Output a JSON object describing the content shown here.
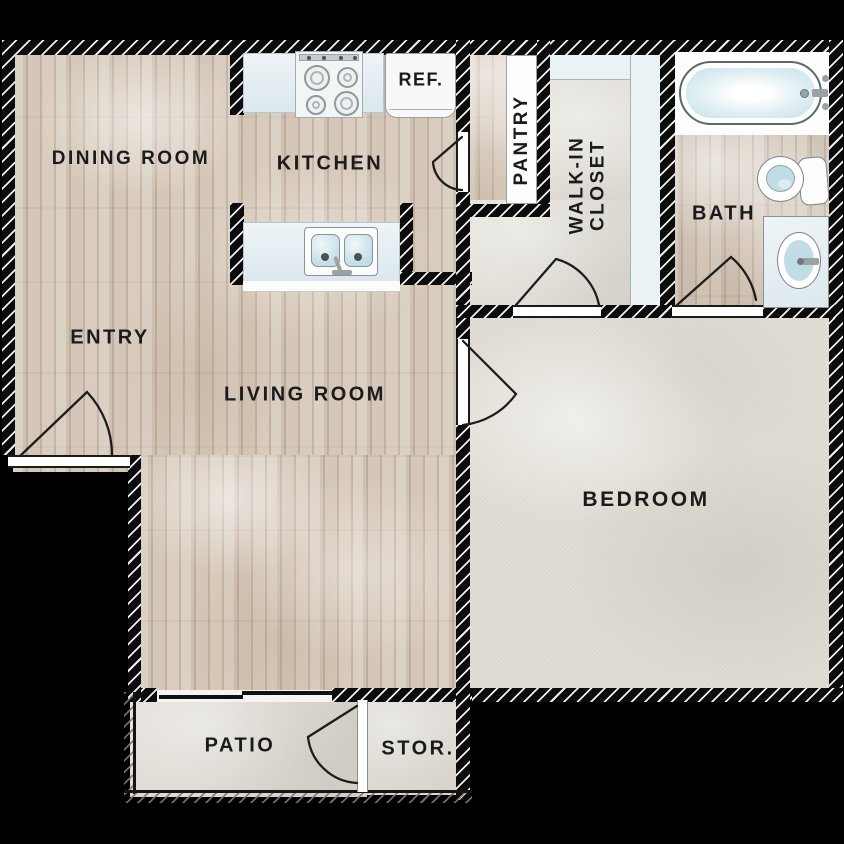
{
  "plan_title": "One bedroom apartment floor plan",
  "rooms": {
    "dining_room": "DINING ROOM",
    "kitchen": "KITCHEN",
    "entry": "ENTRY",
    "living_room": "LIVING ROOM",
    "bedroom": "BEDROOM",
    "bath": "BATH",
    "pantry": "PANTRY",
    "walk_in_closet_line1": "WALK-IN",
    "walk_in_closet_line2": "CLOSET",
    "patio": "PATIO",
    "storage": "STOR."
  },
  "fixtures": {
    "refrigerator": "REF.",
    "stove": "4-burner stove",
    "kitchen_sink": "double-basin sink",
    "bathtub": "bathtub",
    "toilet": "toilet",
    "vanity_sink": "vanity sink"
  },
  "colors": {
    "wall": "#0c0c0c",
    "wall_hatch": "#fafafa",
    "wood_floor": "#cfc1b1",
    "carpet": "#e2ded6",
    "concrete": "#ddd8d0",
    "counter": "#e6eef3",
    "water": "#c6e0e9",
    "label_text": "#1b1b1b"
  }
}
